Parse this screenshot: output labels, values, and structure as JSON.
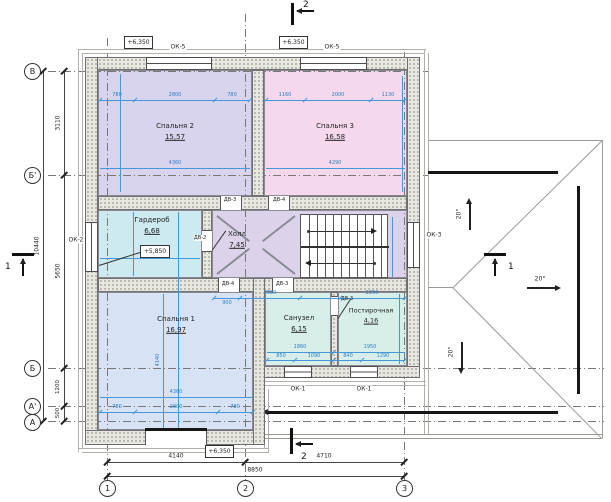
{
  "axes": {
    "rows": [
      "В",
      "Б'",
      "Б",
      "А'",
      "А"
    ],
    "cols": [
      "1",
      "2",
      "3"
    ]
  },
  "dims": {
    "left_total": "10440",
    "left": [
      "3110",
      "5650",
      "1200",
      "500"
    ],
    "bottom": [
      "4140",
      "4710"
    ],
    "bottom_total": "8850"
  },
  "rooms": [
    {
      "name": "Спальня 2",
      "area": "15,57"
    },
    {
      "name": "Спальня 3",
      "area": "16,58"
    },
    {
      "name": "Гардероб",
      "area": "6,68"
    },
    {
      "name": "Холл",
      "area": "7,45"
    },
    {
      "name": "Спальня 1",
      "area": "16,97"
    },
    {
      "name": "Санузел",
      "area": "6,15"
    },
    {
      "name": "Постирочная",
      "area": "4,16"
    }
  ],
  "windows": {
    "ok5": "ОК-5",
    "ok2": "ОК-2",
    "ok3": "ОК-3",
    "ok1": "ОК-1"
  },
  "doors": {
    "dv2": "ДВ-2",
    "dv3": "ДВ-3",
    "dv4": "ДВ-4"
  },
  "elevations": {
    "level": "+6,350",
    "wardrobe": "+5,850"
  },
  "roof": {
    "slope": "20°"
  },
  "sections": {
    "one": "1",
    "two": "2"
  },
  "blue": {
    "sp2": [
      "780",
      "2800",
      "780"
    ],
    "sp2_total": "4360",
    "sp3": [
      "1160",
      "2000",
      "1130"
    ],
    "sp3_total": "4290",
    "wardrobe_total": "3020",
    "hall": [
      "900",
      "2580",
      "2250"
    ],
    "sp1": [
      "780",
      "2800",
      "780"
    ],
    "sp1_total": "4360",
    "sp1_h": "4140",
    "san_total": "1860",
    "laundry_total": "1950",
    "san_chain": [
      "850",
      "1090",
      "840",
      "1290"
    ]
  }
}
